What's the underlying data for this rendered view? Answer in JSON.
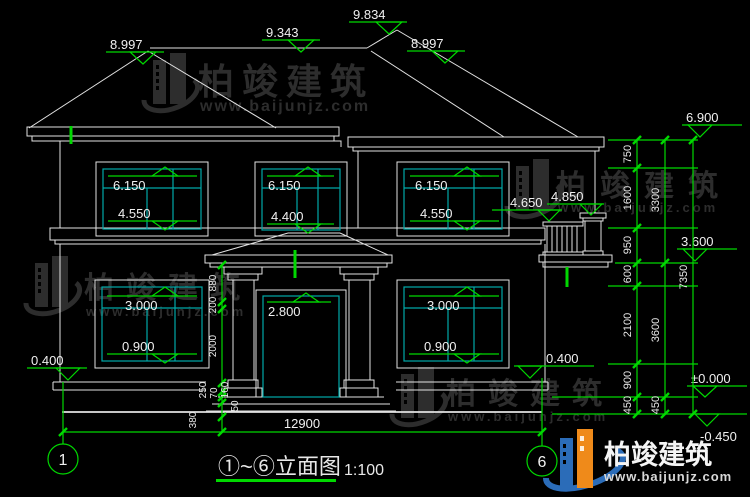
{
  "drawing": {
    "title": "①~⑥立面图",
    "scale": "1:100"
  },
  "axes": {
    "start": "1",
    "end": "6"
  },
  "brand": {
    "name": "柏竣建筑",
    "url": "www.baijunjz.com"
  },
  "colors": {
    "background": "#000000",
    "line_white": "#e2e2e2",
    "glass_teal": "#00a8a8",
    "dimension_green": "#00d800",
    "watermark_gray": "#2d2d2d",
    "logo_blue": "#2b6cb8",
    "logo_orange": "#ef8a1a"
  },
  "elevation_markers": {
    "roof_left_peak": "8.997",
    "ridge": "9.343",
    "main_peak": "9.834",
    "roof_right_slope": "8.997",
    "eave_right": "6.900",
    "pillar_top": "4.850",
    "rail_top": "4.650",
    "floor_slab": "3.600",
    "ground": "±0.000",
    "footing": "-0.450",
    "plinth_left": "0.400",
    "plinth_right": "0.400"
  },
  "windows": {
    "f2_left_top": "6.150",
    "f2_left_sill": "4.550",
    "f2_mid_top": "6.150",
    "f2_mid_sill": "4.400",
    "f2_right_top": "6.150",
    "f2_right_sill": "4.550",
    "f1_left_top": "3.000",
    "f1_left_sill": "0.900",
    "f1_right_top": "3.000",
    "f1_right_sill": "0.900",
    "door_top": "2.800"
  },
  "dims": {
    "right_inner": [
      "750",
      "1600",
      "950",
      "600",
      "2100",
      "900",
      "450"
    ],
    "right_middle": [
      "3300",
      "3600",
      "450"
    ],
    "right_total": "7350",
    "porch": [
      "880",
      "200",
      "2000",
      "250",
      "160",
      "70",
      "50",
      "380"
    ],
    "width_total": "12900"
  }
}
